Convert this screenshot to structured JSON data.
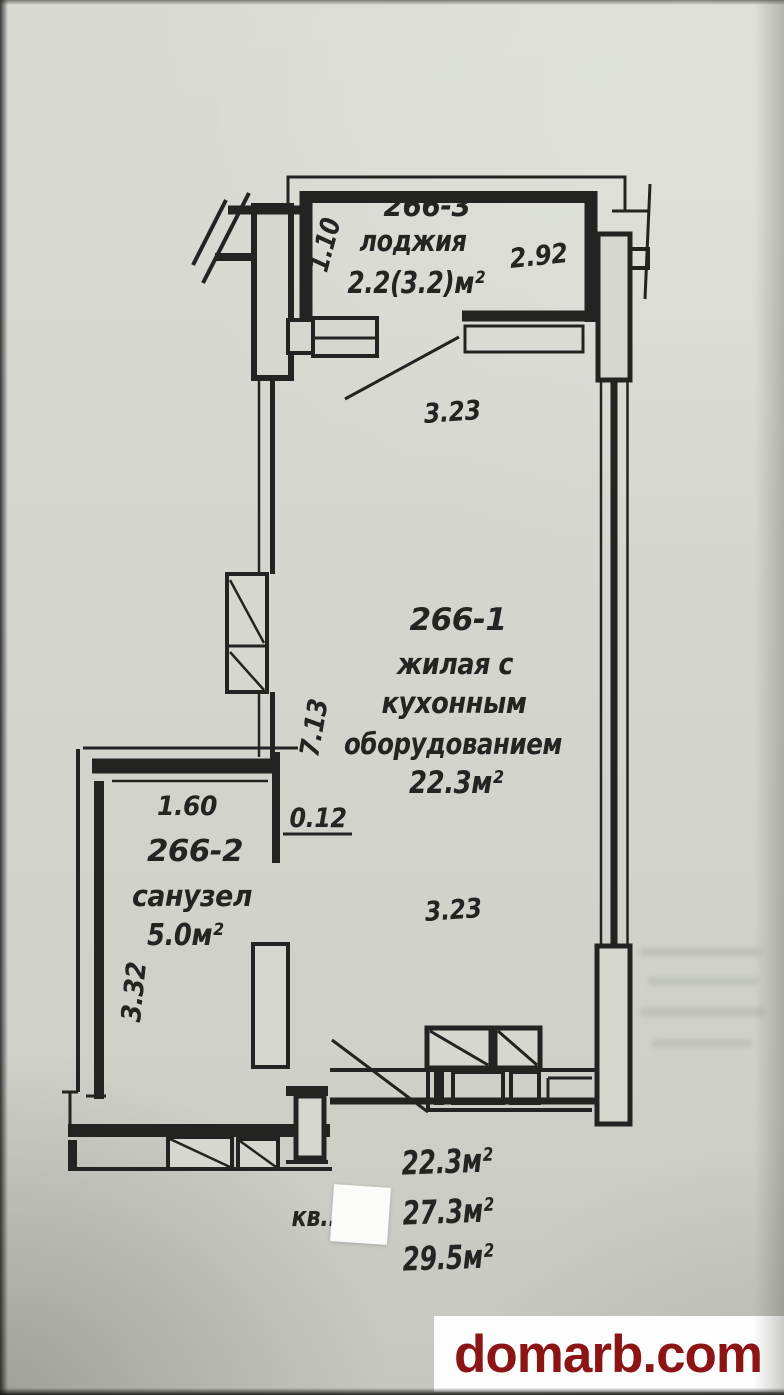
{
  "rooms": {
    "loggia": {
      "number": "266-3",
      "name": "лоджия",
      "area": "2.2(3.2)м²"
    },
    "living": {
      "number": "266-1",
      "name_line1": "жилая с",
      "name_line2": "кухонным",
      "name_line3": "оборудованием",
      "area": "22.3м²"
    },
    "bathroom": {
      "number": "266-2",
      "name": "санузел",
      "area": "5.0м²"
    }
  },
  "dimensions": {
    "loggia_depth": "1.10",
    "loggia_width": "2.92",
    "room_width_top": "3.23",
    "room_width_bottom": "3.23",
    "room_depth": "7.13",
    "wall_thickness": "0.12",
    "bathroom_width": "1.60",
    "bathroom_depth": "3.32"
  },
  "summary": {
    "apartment_prefix": "кв..",
    "living_area": "22.3м²",
    "total_area": "27.3м²",
    "total_with_loggia": "29.5м²"
  },
  "watermark": {
    "text": "domarb.com"
  },
  "colors": {
    "ink": "#222220",
    "paper": "#d5d7cf",
    "watermark_red": "#8d1414",
    "patch_white": "#fbfbfa"
  }
}
